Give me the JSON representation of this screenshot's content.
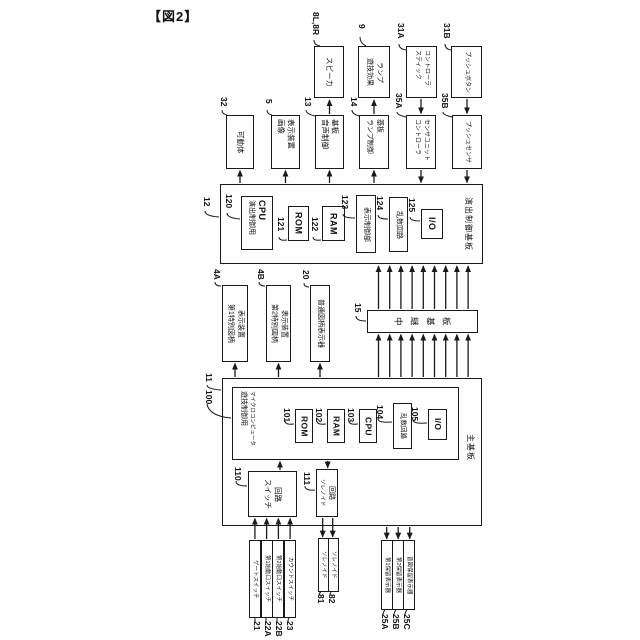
{
  "figure_label": "【図2】",
  "colors": {
    "line": "#1a1a1a",
    "background": "#ffffff",
    "text": "#111111"
  },
  "boxes": {
    "speaker": {
      "ref": "8L,8R",
      "l1": "スピーカ"
    },
    "lamp": {
      "ref": "9",
      "l1": "遊技効果",
      "l2": "ランプ"
    },
    "stick": {
      "ref": "31A",
      "l1": "スティック",
      "l2": "コントローラ"
    },
    "pushbtn": {
      "ref": "31B",
      "l1": "プッシュボタン"
    },
    "movable": {
      "ref": "32",
      "l1": "可動体"
    },
    "image": {
      "ref": "5",
      "l1": "画像",
      "l2": "表示装置"
    },
    "sound": {
      "ref": "13",
      "l1": "音声制御",
      "l2": "基板"
    },
    "lampctl": {
      "ref": "14",
      "l1": "ランプ制御",
      "l2": "基板"
    },
    "ctrlsensor": {
      "ref": "35A",
      "l1": "コントローラ",
      "l2": "センサユニット"
    },
    "pushsensor": {
      "ref": "35B",
      "l1": "プッシュセンサ"
    },
    "effect_board": {
      "ref": "12",
      "label": "演出制御基板"
    },
    "cpu120": {
      "ref": "120",
      "l1": "演出制御用",
      "l2": "CPU"
    },
    "rom121": {
      "ref": "121",
      "l1": "ROM"
    },
    "ram122": {
      "ref": "122",
      "l1": "RAM"
    },
    "dispctl": {
      "ref": "123",
      "l1": "表示制御部"
    },
    "rand124": {
      "ref": "124",
      "l1": "乱数回路"
    },
    "io125": {
      "ref": "125",
      "l1": "I/O"
    },
    "disp4a": {
      "ref": "4A",
      "l1": "第1特別図柄",
      "l2": "表示装置"
    },
    "disp4b": {
      "ref": "4B",
      "l1": "第2特別図柄",
      "l2": "表示装置"
    },
    "disp20": {
      "ref": "20",
      "l1": "普通図柄表示器"
    },
    "relay": {
      "ref": "15",
      "label": "中継基板"
    },
    "main_board": {
      "ref": "11",
      "label": "主基板"
    },
    "micro": {
      "ref": "100",
      "l1": "遊技制御用",
      "l2": "マイクロコンピュータ"
    },
    "rom101": {
      "ref": "101",
      "l1": "ROM"
    },
    "ram102": {
      "ref": "102",
      "l1": "RAM"
    },
    "cpu103": {
      "ref": "103",
      "l1": "CPU"
    },
    "rand104": {
      "ref": "104",
      "l1": "乱数回路"
    },
    "io105": {
      "ref": "105",
      "l1": "I/O"
    },
    "switch110": {
      "ref": "110",
      "l1": "スイッチ",
      "l2": "回路"
    },
    "sol111": {
      "ref": "111",
      "l1": "ソレノイド",
      "l2": "回路"
    },
    "gate21": {
      "ref": "21",
      "l1": "ゲートスイッチ"
    },
    "start22a": {
      "ref": "22A",
      "l1": "第1始動口スイッチ"
    },
    "start22b": {
      "ref": "22B",
      "l1": "第2始動口スイッチ"
    },
    "count23": {
      "ref": "23",
      "l1": "カウントスイッチ"
    },
    "sol81": {
      "ref": "81",
      "l1": "ソレノイド"
    },
    "sol82": {
      "ref": "82",
      "l1": "ソレノイド"
    },
    "hold25a": {
      "ref": "25A",
      "l1": "第1保留表示器"
    },
    "hold25b": {
      "ref": "25B",
      "l1": "第2保留表示器"
    },
    "hold25c": {
      "ref": "25C",
      "l1": "普図保留表示器"
    }
  }
}
